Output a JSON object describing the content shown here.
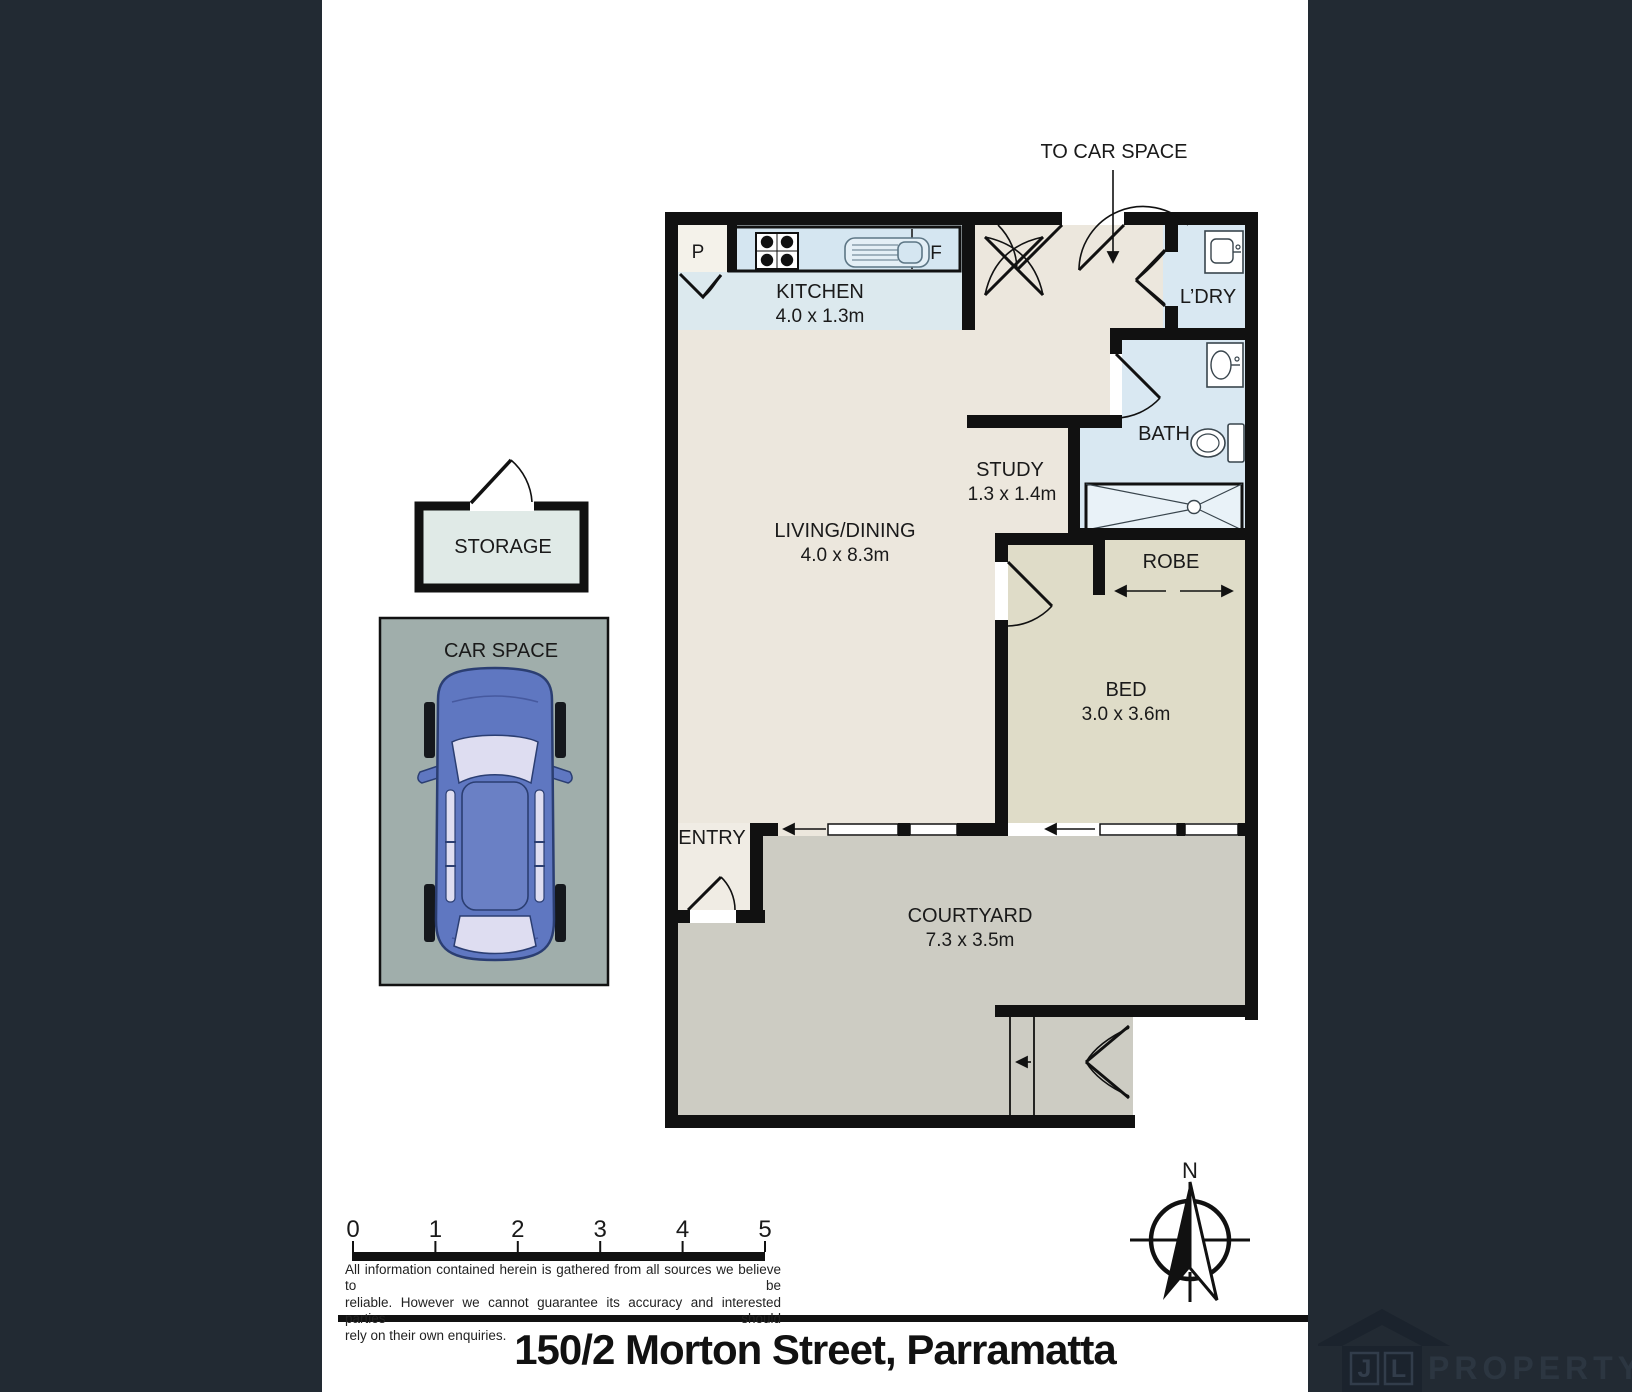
{
  "sheet": {
    "background": "#222A33",
    "paper": "#FFFFFF",
    "address": "150/2 Morton Street, Parramatta"
  },
  "plan": {
    "to_car_space": "TO CAR SPACE",
    "rooms": {
      "kitchen": {
        "name": "KITCHEN",
        "dims": "4.0 x 1.3m"
      },
      "living_dining": {
        "name": "LIVING/DINING",
        "dims": "4.0 x 8.3m"
      },
      "study": {
        "name": "STUDY",
        "dims": "1.3 x 1.4m"
      },
      "bath": {
        "name": "BATH"
      },
      "laundry": {
        "name": "L’DRY"
      },
      "robe": {
        "name": "ROBE"
      },
      "bed": {
        "name": "BED",
        "dims": "3.0 x 3.6m"
      },
      "entry": {
        "name": "ENTRY"
      },
      "courtyard": {
        "name": "COURTYARD",
        "dims": "7.3 x 3.5m"
      },
      "storage": {
        "name": "STORAGE"
      },
      "car_space": {
        "name": "CAR SPACE"
      }
    },
    "markers": {
      "pantry": "P",
      "fridge": "F"
    },
    "room_colors": {
      "wet_areas": "#D9E8F2",
      "kitchen_zone": "#DCE9EE",
      "living": "#ECE7DD",
      "bed_robe": "#DFDCC8",
      "courtyard": "#CDCCC3",
      "car_space": "#A0AEAB",
      "storage": "#E0EAE7",
      "walls": "#111111"
    }
  },
  "compass": {
    "north": "N"
  },
  "scale_bar": {
    "labels": [
      "0",
      "1",
      "2",
      "3",
      "4",
      "5"
    ]
  },
  "disclaimer": {
    "line1": "All information contained herein is gathered from all sources we believe to be",
    "line2": "reliable. However we cannot guarantee its accuracy and interested parties should",
    "line3": "rely on their own enquiries."
  },
  "logo": {
    "initial_j": "J",
    "initial_l": "L",
    "wordmark": "PROPERTY"
  },
  "icons": [
    "stove-icon",
    "sink-icon",
    "washing-machine-icon",
    "basin-icon",
    "toilet-icon",
    "shower-icon",
    "car-icon",
    "north-compass-icon",
    "house-logo-icon"
  ]
}
